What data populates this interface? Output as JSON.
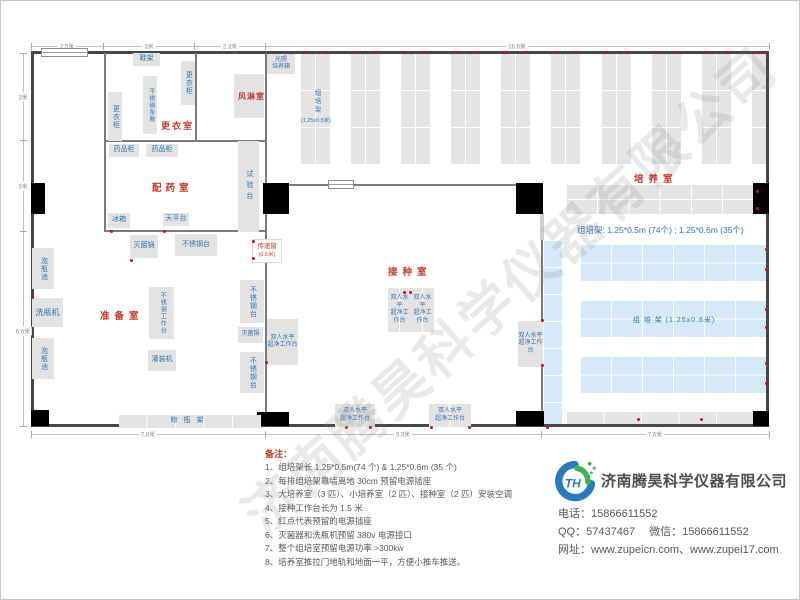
{
  "watermark": "济南腾昊科学仪器有限公司",
  "plan": {
    "rooms": [
      {
        "id": "dressing-room",
        "label": "更衣室"
      },
      {
        "id": "air-shower",
        "label": "风淋室"
      },
      {
        "id": "dispensing-room",
        "label": "配药室"
      },
      {
        "id": "prep-room",
        "label": "准备室"
      },
      {
        "id": "inoculation-room",
        "label": "接种室"
      },
      {
        "id": "culture-room",
        "label": "培养室"
      }
    ],
    "furniture": [
      {
        "id": "shoe-rack",
        "label": "鞋架"
      },
      {
        "id": "locker-right",
        "label": "更衣柜"
      },
      {
        "id": "steel-bench",
        "label": "不锈钢条凳"
      },
      {
        "id": "locker-left",
        "label": "更衣柜"
      },
      {
        "id": "light-incubator",
        "label": "光照培养箱"
      },
      {
        "id": "medicine-cabinet-1",
        "label": "药品柜"
      },
      {
        "id": "medicine-cabinet-2",
        "label": "药品柜"
      },
      {
        "id": "test-bench",
        "label": "试验台"
      },
      {
        "id": "fridge",
        "label": "冰箱"
      },
      {
        "id": "balance-table",
        "label": "天平台"
      },
      {
        "id": "sterilizer-1",
        "label": "灭菌锅"
      },
      {
        "id": "steel-table-1",
        "label": "不锈钢台"
      },
      {
        "id": "soak-pool-1",
        "label": "泡瓶池"
      },
      {
        "id": "bottle-washer",
        "label": "洗瓶机"
      },
      {
        "id": "soak-pool-2",
        "label": "泡瓶池"
      },
      {
        "id": "steel-worktable",
        "label": "不锈钢工作台"
      },
      {
        "id": "filling-machine",
        "label": "灌装机"
      },
      {
        "id": "steel-table-2",
        "label": "不锈钢台"
      },
      {
        "id": "sterilizer-2",
        "label": "灭菌锅"
      },
      {
        "id": "steel-table-3",
        "label": "不锈钢台"
      },
      {
        "id": "drying-rack",
        "label": "晾瓶架"
      },
      {
        "id": "clean-bench-c1",
        "label": "双人水平超净工作台"
      },
      {
        "id": "clean-bench-c2",
        "label": "双人水平超净工作台"
      },
      {
        "id": "clean-bench-left",
        "label": "双人水平超净工作台"
      },
      {
        "id": "clean-bench-right",
        "label": "双人水平超净工作台"
      },
      {
        "id": "clean-bench-b1",
        "label": "双人水平超净工作台"
      },
      {
        "id": "clean-bench-b2",
        "label": "双人水平超净工作台"
      }
    ],
    "pass_window": {
      "line1": "传递窗",
      "line2": "(0.6米)"
    },
    "rack_tag_top": {
      "name": "组培架",
      "size": "(1.25x0.5米)"
    },
    "rack_tag_blue": "组 培 架 (1.25x0.6米)",
    "rack_summary": "组培架: 1.25*0.5m (74个) ; 1.25*0.6m (35个)",
    "dimensions": {
      "top": [
        "2.5米",
        "3米",
        "2.3米",
        "16.9米"
      ],
      "left": [
        "3米",
        "3米",
        "6.6米"
      ],
      "bottom": [
        "7.8米",
        "9.3米",
        "7.6米"
      ]
    }
  },
  "notes": {
    "title": "备注：",
    "items": [
      "1、组培架长 1.25*0.5m(74 个) & 1.25*0.6m (35 个)",
      "2、每排组培架靠墙离地 30cm 预留电源插座",
      "3、大培养室（3 匹）、小培养室（2 匹）、接种室（2 匹）安装空调",
      "4、接种工作台长为 1.5 米",
      "5、红点代表预留的电源插座",
      "6、灭菌器和洗瓶机预留 380v 电源接口",
      "7、整个组培室预留电源功率 >300kw",
      "8、培养室推拉门地轨和地面一平，方便小推车推送。"
    ]
  },
  "company": {
    "name": "济南腾昊科学仪器有限公司",
    "logo_monogram": "TH",
    "phone_label": "电话：",
    "phone": "15866611552",
    "qq_label": "QQ：",
    "qq": "57437467",
    "wechat_label": "微信：",
    "wechat": "15866611552",
    "web_label": "网址：",
    "websites": "www.zupeicn.com、www.zupei17.com"
  },
  "colors": {
    "room_label": "#c0392b",
    "furniture_text": "#2e74b5",
    "rack_gray": "#e4e4e4",
    "rack_blue": "#d5e9f8",
    "outlet_dot": "#cc1111",
    "wall": "#474747"
  }
}
